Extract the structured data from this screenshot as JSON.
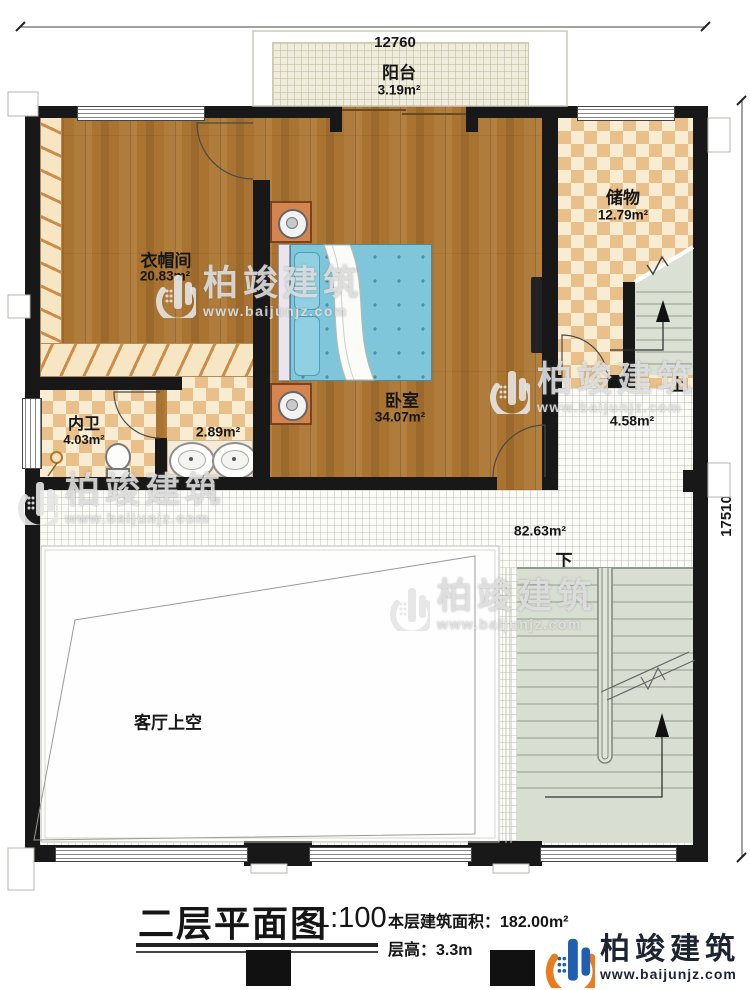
{
  "plan": {
    "dimensions": {
      "top": "12760",
      "right": "17510"
    },
    "rooms": {
      "balcony": {
        "name": "阳台",
        "area": "3.19m²"
      },
      "cloakroom": {
        "name": "衣帽间",
        "area": "20.83m²"
      },
      "bedroom": {
        "name": "卧室",
        "area": "34.07m²"
      },
      "storage": {
        "name": "储物",
        "area": "12.79m²"
      },
      "bathroom": {
        "name": "内卫",
        "area": "4.03m²"
      },
      "vanity": {
        "area": "2.89m²"
      },
      "landing": {
        "area": "4.58m²"
      },
      "hall": {
        "area": "82.63m²"
      },
      "void": {
        "name": "客厅上空"
      }
    },
    "stairs": {
      "up": "上",
      "down": "下"
    }
  },
  "watermark": {
    "brand": "柏竣建筑",
    "url": "www.baijunjz.com"
  },
  "footer": {
    "title": "二层平面图",
    "scale": "1:100",
    "area_line_label": "本层建筑面积：",
    "area_line_value": "182.00m²",
    "height_line_label": "层高：",
    "height_line_value": "3.3m",
    "logo_brand": "柏竣建筑",
    "logo_url": "www.baijunjz.com"
  },
  "colors": {
    "wall": "#181818",
    "wood": "#a97331",
    "checker": "#e9c08a",
    "tile": "#fbfbf8",
    "stair": "#d9ded2",
    "bed": "#7fc6da",
    "accent_orange": "#e87c1e",
    "brand_blue": "#1f5fae"
  }
}
